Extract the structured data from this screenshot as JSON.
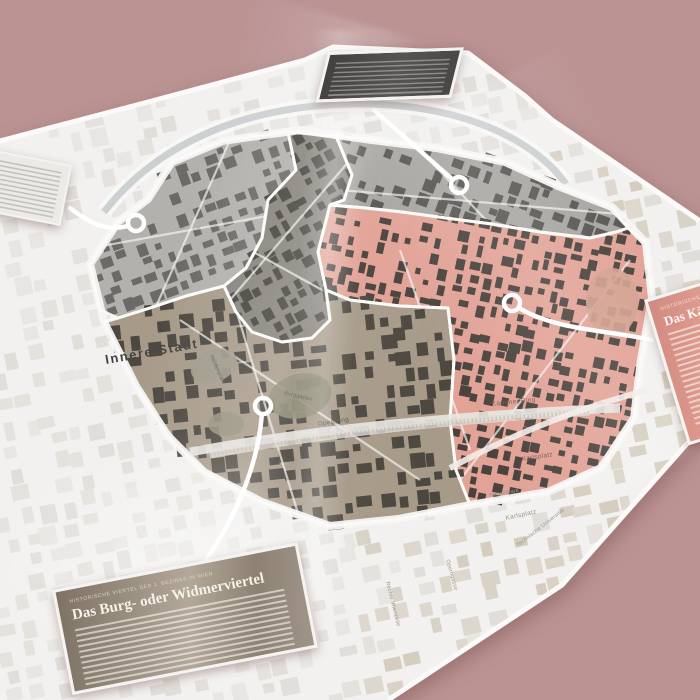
{
  "photo": {
    "background_color": "#bb9393"
  },
  "map": {
    "area_label": "Innere Stadt",
    "street_labels": {
      "opernring": "Opernring",
      "kaerntner_ring": "Kärntner Ring",
      "karlsplatz_inner": "Karlsplatz",
      "karlsplatz_outer": "Karlsplatz",
      "resselpark": "Resselpark",
      "technische_universitaet": "Technische Universität",
      "operngasse": "Operngasse",
      "rechte_wienzeile": "Rechte Wienzeile",
      "heldenplatz": "Heldenplatz",
      "burggarten": "Burggarten"
    },
    "colors": {
      "sheet": "#f2f1ef",
      "outer_blocks_light": [
        "#e8e6e2",
        "#e1deda",
        "#e5e2dd"
      ],
      "outer_blocks_beige": [
        "#d9d2c6",
        "#ddd7cd",
        "#d5cdbf"
      ],
      "ring_road": "#f7f6f4",
      "canal": "#c6c9ca",
      "railway_band": "#dedbd5",
      "railway_hatch": "#c0bcb4",
      "quarters": {
        "northwest_gray": {
          "base": "#b3b1ad",
          "building": "#6b6a67"
        },
        "center_dark": {
          "base": "#86827b",
          "building": "#45423d"
        },
        "northeast_gray": {
          "base": "#a7a5a1",
          "building": "#575550"
        },
        "east_pink": {
          "base": "#e2a296",
          "building": "#4a423c"
        },
        "south_taupe": {
          "base": "#a79a89",
          "building": "#4c473f"
        }
      },
      "park_green_taupe": "#8f8c77",
      "park_pink": "#d3a08e",
      "pin": "#ffffff"
    }
  },
  "cards": {
    "kicker": "Historische Viertel des 1. Bezirks in Wien",
    "burgviertel_title": "Das Burg- oder Widmerviertel",
    "kaerntnerviertel_title": "Das Kärntnerviertel"
  }
}
